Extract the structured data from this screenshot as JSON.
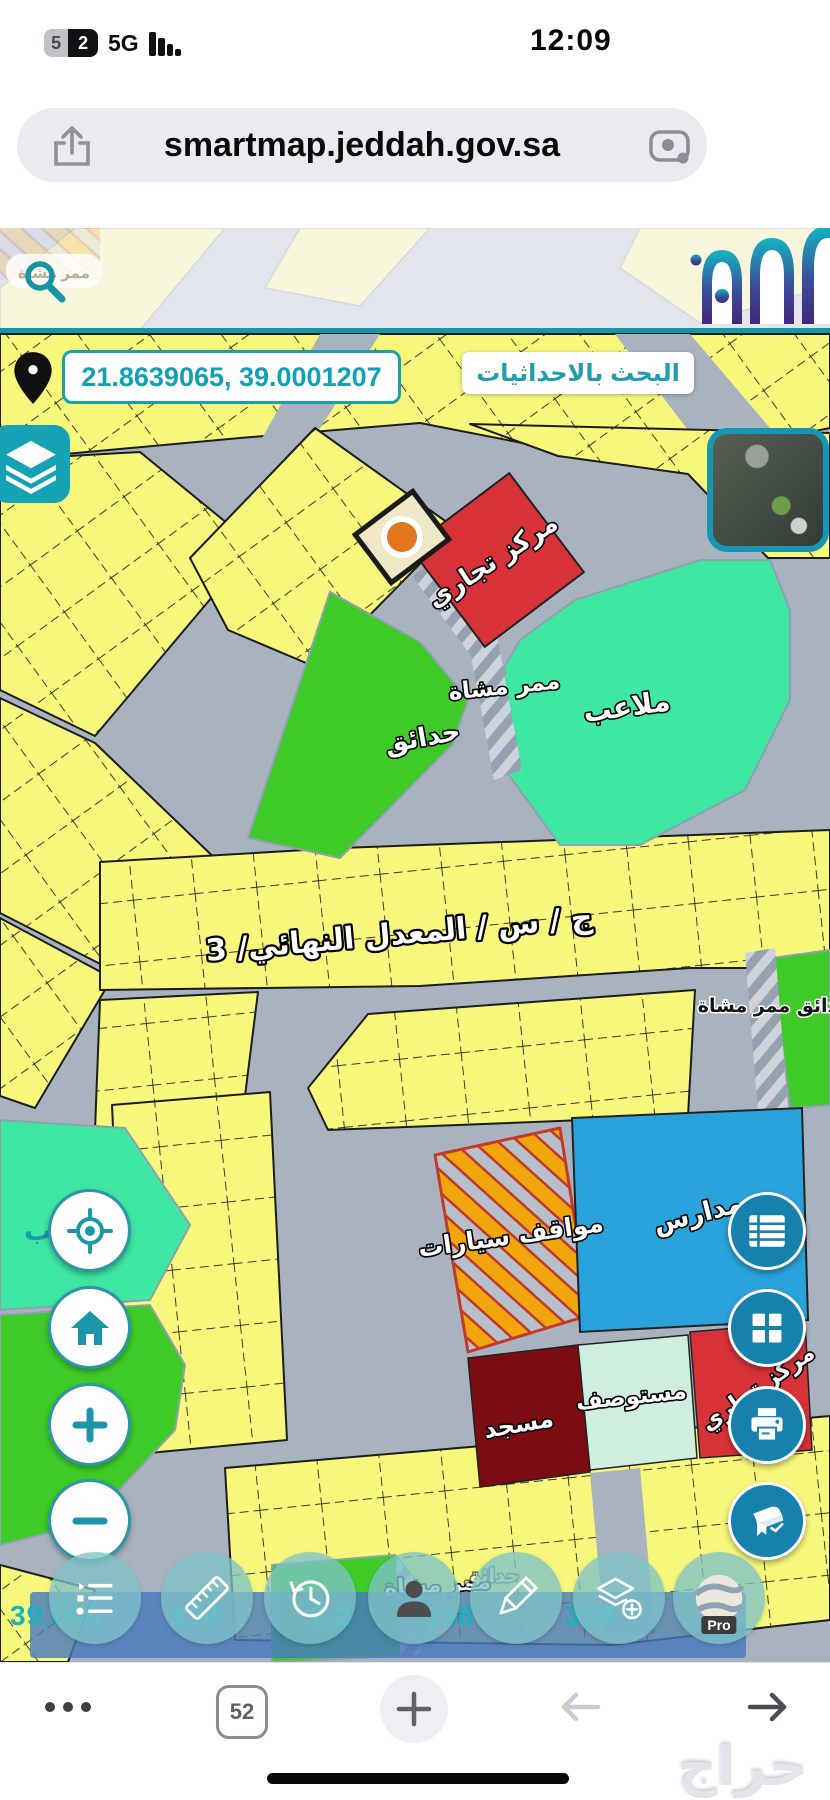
{
  "status_bar": {
    "battery_percent": "52",
    "battery_digit_left": "5",
    "battery_digit_right": "2",
    "network": "5G",
    "time": "12:09"
  },
  "address_bar": {
    "url": "smartmap.jeddah.gov.sa"
  },
  "map": {
    "coordinates": {
      "value": "21.8639065, 39.0001207"
    },
    "search_by_coordinates_label": "البحث بالاحداثيات",
    "labels": {
      "commercial_center": "مركز تجاري",
      "pedestrian_path": "ممر مشاة",
      "parks": "حدائق",
      "playgrounds": "ملاعب",
      "street": "ج / س / المعدل النهائي/ 3",
      "parks_pedestrian_path": "حدائق ممر مشاة",
      "parking": "مواقف سيارات",
      "schools": "مدارس",
      "mosque": "مسجد",
      "clinic": "مستوصف",
      "commercial_center_2": "مركز تجاري",
      "pedestrian_path_bottom": "ممر مشاة",
      "parks_bottom": "حدائق",
      "pedestrian_path_top": "ممر مشاة",
      "partial_label": "ب"
    },
    "coordinate_bar_segments": [
      "39.000",
      "150",
      "2,2",
      "138",
      "358"
    ],
    "pro_badge": "Pro",
    "colors": {
      "parcel_yellow": "#f6f77b",
      "road_gray": "#a9b3c0",
      "teal_accent": "#1796a8",
      "park_green": "#3ecb28",
      "playground_mint": "#3fe8a2",
      "commercial_red": "#d63238",
      "school_blue": "#2aa2dc",
      "mosque_maroon": "#7b0c12",
      "clinic_mint": "#cfeedd",
      "parking_orange": "#eea211",
      "button_blue": "#1681ad",
      "selected_parcel_dot": "#e2761d"
    }
  },
  "browser_bar": {
    "tabs_count": "52"
  },
  "watermark": "حراج"
}
